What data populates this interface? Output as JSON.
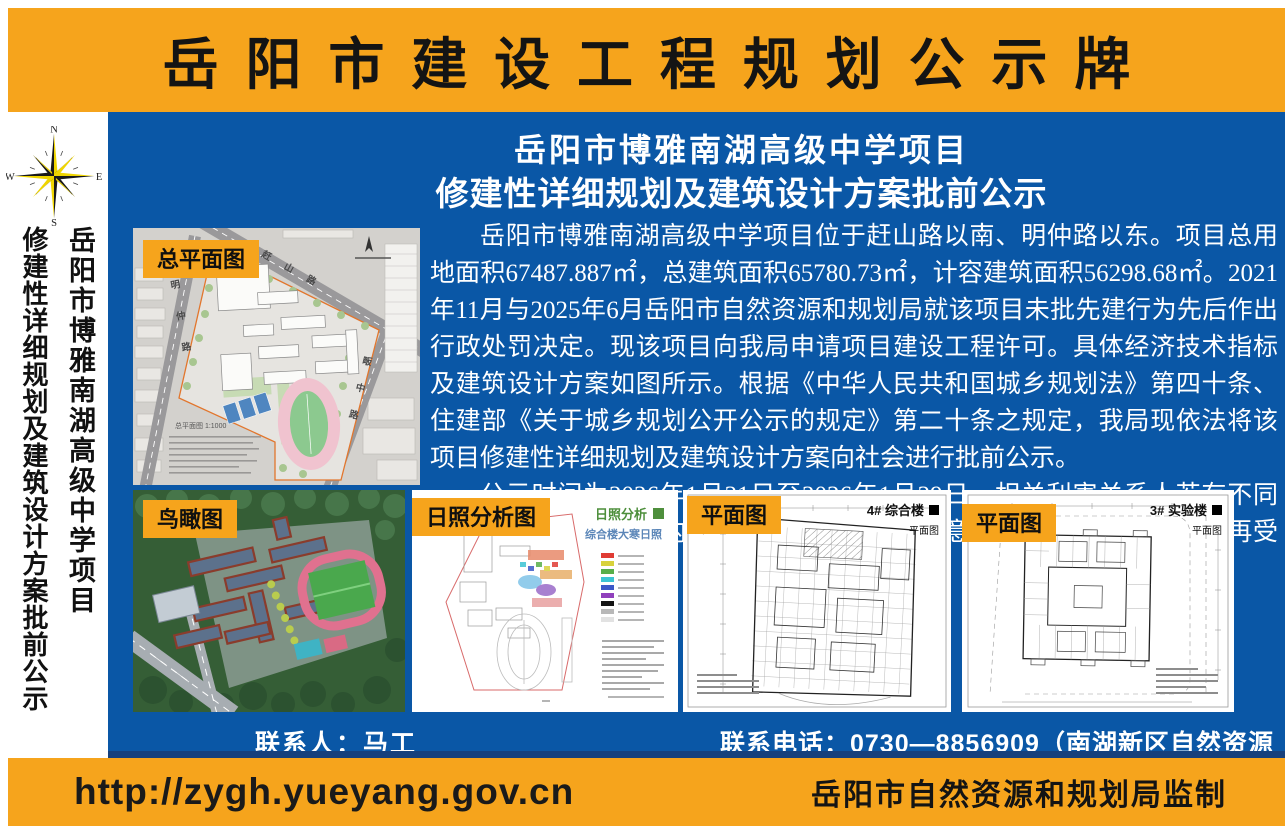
{
  "banner": {
    "title": "岳阳市建设工程规划公示牌"
  },
  "sidebar": {
    "compass": {
      "n": "N",
      "e": "E",
      "s": "S",
      "w": "W"
    },
    "vertical_line1": "岳阳市博雅南湖高级中学项目",
    "vertical_line2": "修建性详细规划及建筑设计方案批前公示"
  },
  "main": {
    "title_line1": "岳阳市博雅南湖高级中学项目",
    "title_line2": "修建性详细规划及建筑设计方案批前公示",
    "paragraph1": "岳阳市博雅南湖高级中学项目位于赶山路以南、明仲路以东。项目总用地面积67487.887㎡，总建筑面积65780.73㎡，计容建筑面积56298.68㎡。2021年11月与2025年6月岳阳市自然资源和规划局就该项目未批先建行为先后作出行政处罚决定。现该项目向我局申请项目建设工程许可。具体经济技术指标及建筑设计方案如图所示。根据《中华人民共和国城乡规划法》第四十条、住建部《关于城乡规划公开公示的规定》第二十条之规定，我局现依法将该项目修建性详细规划及建筑设计方案向社会进行批前公示。",
    "paragraph2": "公示时间为2026年1月21日至2026年1月29日，相关利害关系人若有不同意见，请在公示日期内以书面形式向我局提出意见或建议，逾期我局不再受理。",
    "panels": {
      "site_plan": {
        "label": "总平面图",
        "caption": "总平面图 1:1000",
        "roads": {
          "top": "赶山路",
          "left": "明仲路",
          "right": "畈中路"
        }
      },
      "aerial": {
        "label": "鸟瞰图"
      },
      "sunshine": {
        "label": "日照分析图",
        "legend_title": "日照分析",
        "subtitle": "综合楼大寒日照",
        "legend_colors": [
          "#e03c34",
          "#d8d23c",
          "#58ae4a",
          "#3cc4d4",
          "#3c58c8",
          "#9040bc",
          "#141414",
          "#b8b8b8",
          "#e2e2e2"
        ]
      },
      "plan4": {
        "label": "平面图",
        "building": "4# 综合楼",
        "sub": "平面图"
      },
      "plan3": {
        "label": "平面图",
        "building": "3# 实验楼",
        "sub": "平面图"
      }
    },
    "contact_person": "联系人：马工",
    "contact_phone": "联系电话：0730—8856909（南湖新区自然资源局）"
  },
  "footer": {
    "url": "http://zygh.yueyang.gov.cn",
    "supervisor": "岳阳市自然资源和规划局监制"
  },
  "colors": {
    "orange": "#F6A41C",
    "blue": "#0A57A6",
    "navy": "#16407C",
    "compass_yellow": "#EFD500"
  }
}
